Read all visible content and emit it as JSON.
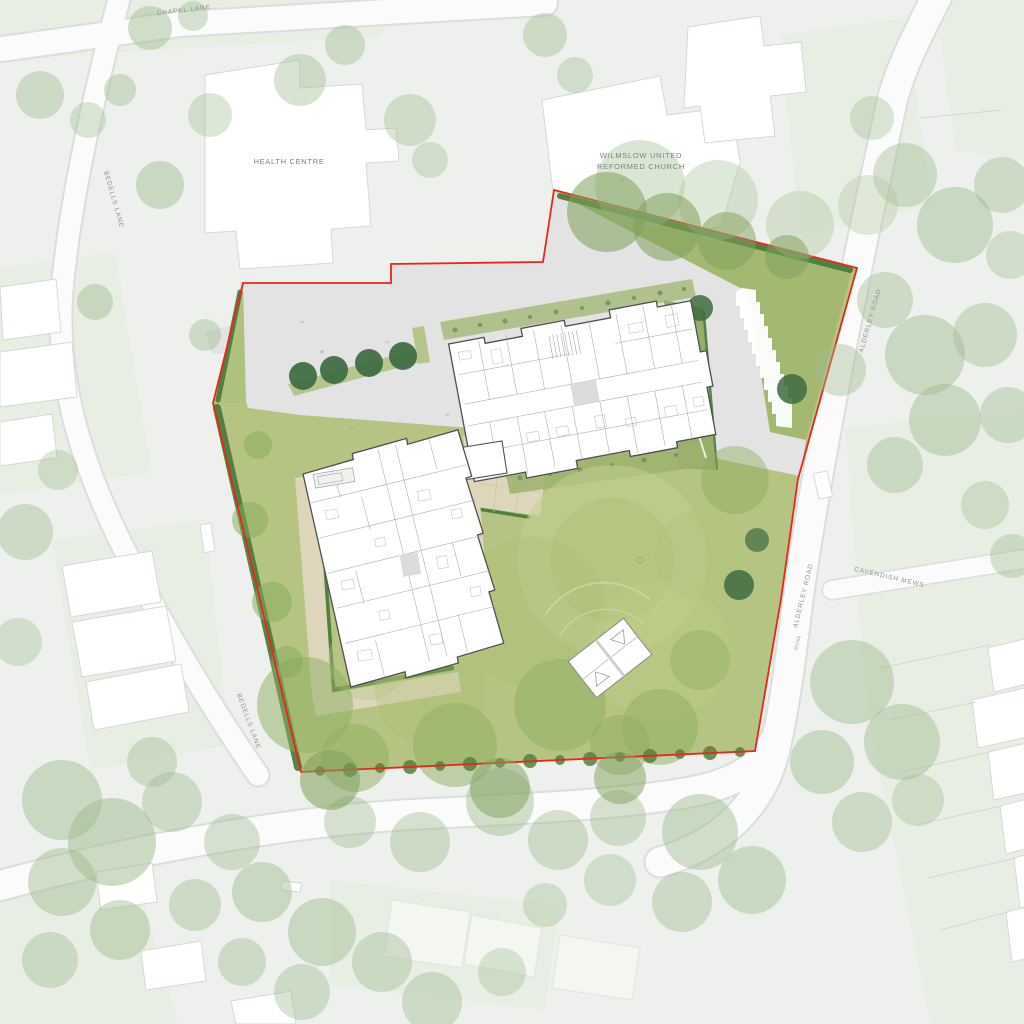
{
  "drawing": {
    "type": "architectural-site-plan",
    "description": "Masterplan of a residential development site in Wilmslow with red line boundary, two apartment buildings, car park, lawns and tree planting"
  },
  "labels": {
    "chapel_lane": "CHAPEL LANE",
    "health_centre": "HEALTH CENTRE",
    "church_line1": "WILMSLOW UNITED",
    "church_line2": "REFORMED CHURCH",
    "bedells_lane_upper": "BEDELLS LANE",
    "bedells_lane_lower": "BEDELLS LANE",
    "alderley_road_upper": "ALDERLEY ROAD",
    "alderley_road_lower": "ALDERLEY ROAD",
    "road_number": "B5086",
    "cavendish_mews": "CAVENDISH MEWS"
  },
  "colors": {
    "background": "#edf0ec",
    "road": "#fafbfa",
    "road_edge": "#dadfd9",
    "parcel_green": "#e8eee4",
    "building_white": "#ffffff",
    "site_lawn": "#b5c482",
    "wedge_lawn": "#a3b972",
    "paving": "#e2e3e2",
    "path_beige": "#ddd6bb",
    "planting": "#9db26e",
    "hedge_dark": "#4b7a3c",
    "tree_canopy": "#9dba8e",
    "tree_canopy_dark": "#7fa05b",
    "tree_specimen": "#3e6b41",
    "boundary_red": "#e8271c",
    "label_text": "#8f948f"
  }
}
